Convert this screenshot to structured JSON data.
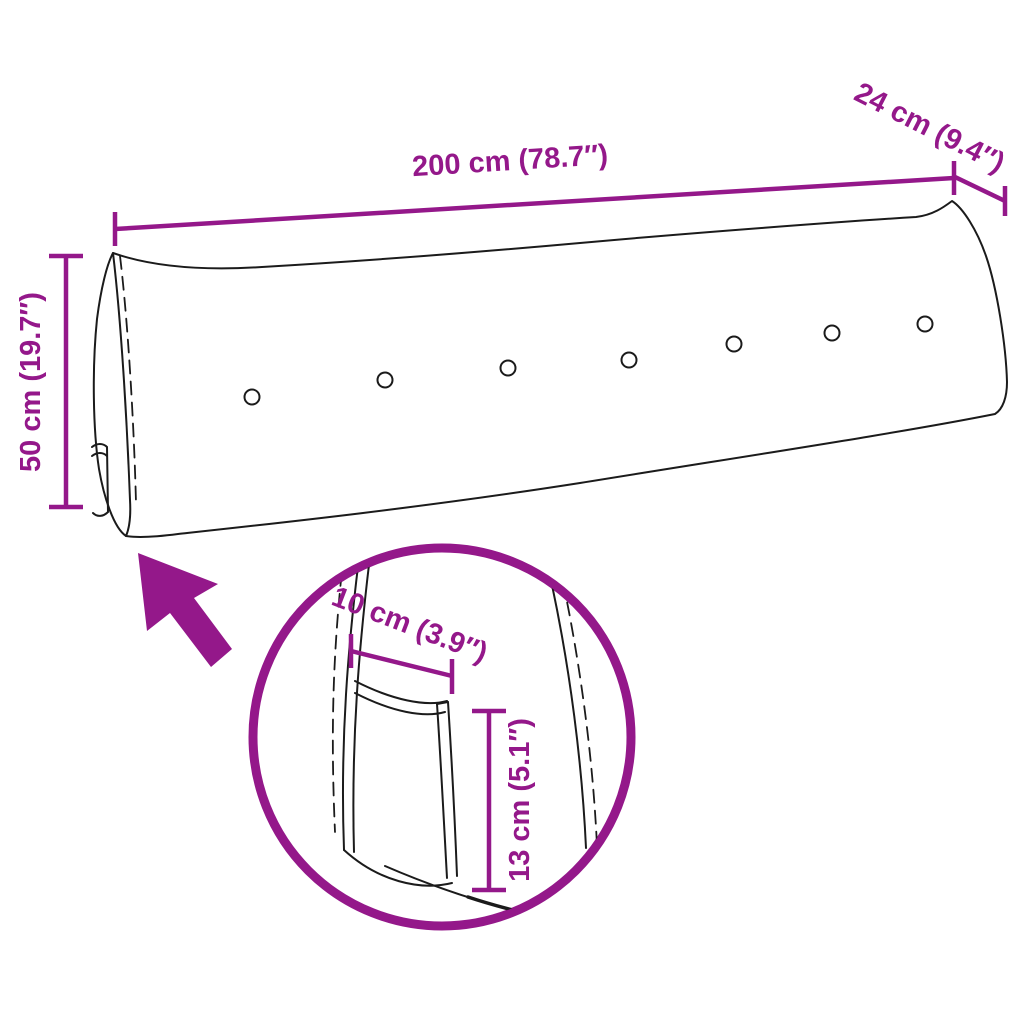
{
  "diagram": {
    "type": "product-dimension-diagram",
    "subject": "wedge-shaped headboard cushion with tufting buttons and side storage pocket",
    "colors": {
      "accent": "#94188A",
      "line": "#1B1B1B",
      "background": "#FFFFFF"
    },
    "dimensions": {
      "width": "200 cm (78.7″)",
      "depth": "24 cm (9.4″)",
      "height": "50 cm (19.7″)",
      "pocket_width": "10 cm (3.9″)",
      "pocket_height": "13 cm (5.1″)"
    },
    "icons": [
      "arrow-icon",
      "magnifier-circle-icon"
    ],
    "button_count": 7
  }
}
